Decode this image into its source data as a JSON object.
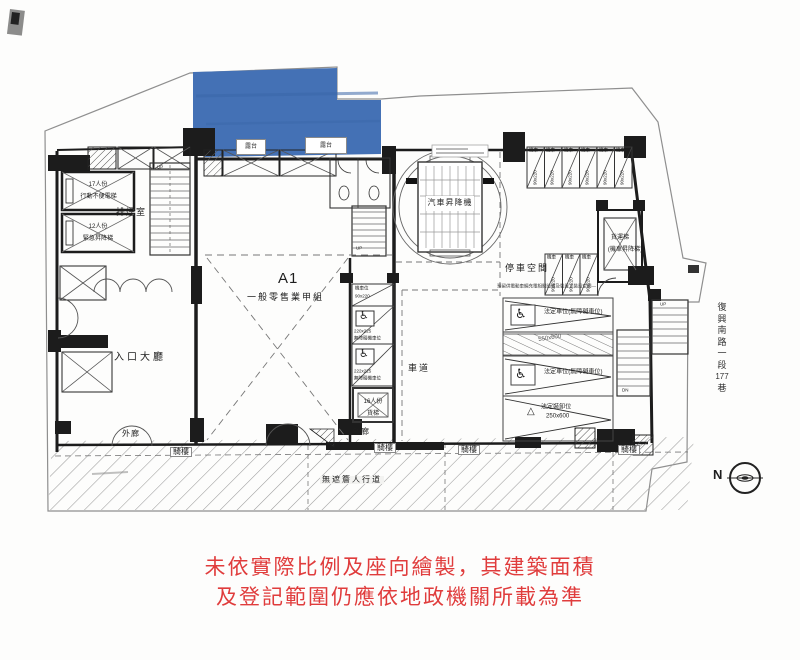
{
  "colors": {
    "highlight_blue": "#4471b5",
    "disclaimer_red": "#e03c3c",
    "wall_black": "#1c1c1c"
  },
  "blue_unit": {
    "terrace_1": "露台",
    "terrace_2": "露台"
  },
  "rooms": {
    "smoke_room": "排煙室",
    "lobby": "入口大廳",
    "corridor_left": "外廊",
    "corridor_right": "外廊",
    "retail_id": "A1",
    "retail_use": "一般零售業甲組",
    "driveway": "車道",
    "parking_space": "停車空間",
    "car_lift": "汽車昇降機"
  },
  "elevators": {
    "passenger_1_line1": "17人份",
    "passenger_1_line2": "行動不便電梯",
    "passenger_2_line1": "12人份",
    "passenger_2_line2": "緊急昇降梯",
    "service_line1": "16人份",
    "service_line2": "貨梯",
    "freight_line1": "貨運梯",
    "freight_line2": "(機車昇降梯)"
  },
  "stairs": {
    "up": "UP",
    "down": "DN"
  },
  "stalls": {
    "moto_tag": "機車",
    "moto_dim": "90x220",
    "moto_stall_tag": "機車位",
    "moto_stall1_dim": "90x220",
    "moto_stall2_dim": "220x225",
    "moto_stall3_dim": "222x225",
    "accessible_note": "無障礙機車位",
    "wheelchair_icon": "♿",
    "warning_icon": "△",
    "car_accessible": "法定車位(無障礙車位)",
    "ramp_dim": "550x600",
    "loading_line1": "法定裝卸位",
    "loading_line2": "250x600",
    "ev_note": "預留供電動車輛充電相關設備及裝置之裝設空間—"
  },
  "street": {
    "arcade": "騎樓",
    "sidewalk": "無遮簷人行道",
    "name_chars": [
      "復",
      "興",
      "南",
      "路",
      "一",
      "段",
      "177",
      "巷"
    ],
    "north": "N"
  },
  "disclaimer": {
    "line1": "未依實際比例及座向繪製，其建築面積",
    "line2": "及登記範圍仍應依地政機關所載為準"
  }
}
